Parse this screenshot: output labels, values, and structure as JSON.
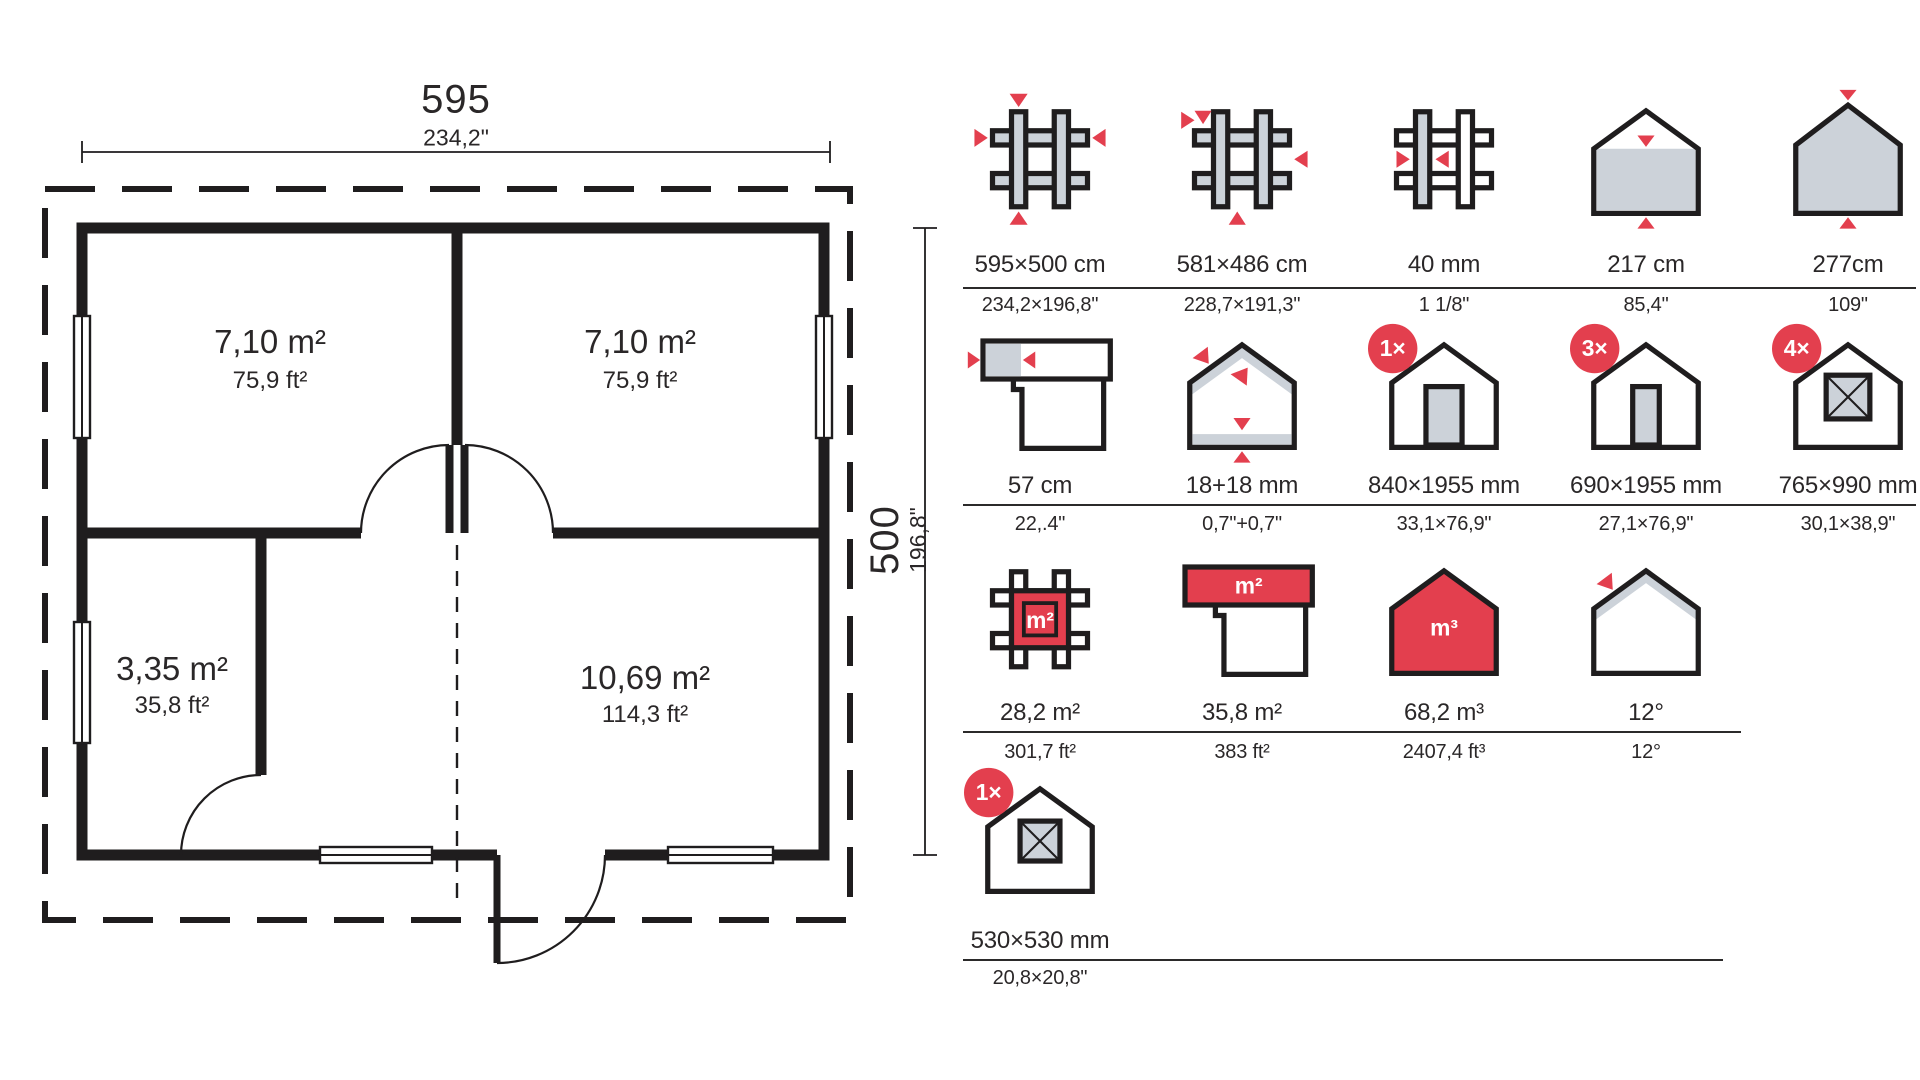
{
  "floor_plan": {
    "width_dim": {
      "value": "595",
      "inches": "234,2\""
    },
    "height_dim": {
      "value": "500",
      "inches": "196,8\""
    },
    "rooms": [
      {
        "area": "7,10 m²",
        "area_ft": "75,9 ft²"
      },
      {
        "area": "7,10 m²",
        "area_ft": "75,9 ft²"
      },
      {
        "area": "3,35 m²",
        "area_ft": "35,8 ft²"
      },
      {
        "area": "10,69 m²",
        "area_ft": "114,3 ft²"
      }
    ]
  },
  "legend": {
    "rows": [
      {
        "items": [
          {
            "icon": "log-frame-outer-dims-icon",
            "metric": "595×500 cm",
            "imperial": "234,2×196,8\""
          },
          {
            "icon": "log-frame-inner-dims-icon",
            "metric": "581×486 cm",
            "imperial": "228,7×191,3\""
          },
          {
            "icon": "wall-thickness-icon",
            "metric": "40 mm",
            "imperial": "1 1/8\""
          },
          {
            "icon": "wall-height-icon",
            "metric": "217 cm",
            "imperial": "85,4\""
          },
          {
            "icon": "ridge-height-icon",
            "metric": "277cm",
            "imperial": "109\""
          }
        ]
      },
      {
        "items": [
          {
            "icon": "roof-overhang-icon",
            "metric": "57 cm",
            "imperial": "22,.4\""
          },
          {
            "icon": "roof-floor-boards-icon",
            "metric": "18+18 mm",
            "imperial": "0,7\"+0,7\""
          },
          {
            "icon": "door-icon",
            "badge": "1×",
            "metric": "840×1955 mm",
            "imperial": "33,1×76,9\""
          },
          {
            "icon": "door-narrow-icon",
            "badge": "3×",
            "metric": "690×1955 mm",
            "imperial": "27,1×76,9\""
          },
          {
            "icon": "window-icon",
            "badge": "4×",
            "metric": "765×990 mm",
            "imperial": "30,1×38,9\""
          }
        ]
      },
      {
        "items": [
          {
            "icon": "footprint-area-icon",
            "icon_label": "m²",
            "metric": "28,2 m²",
            "imperial": "301,7 ft²"
          },
          {
            "icon": "roof-area-icon",
            "icon_label": "m²",
            "metric": "35,8 m²",
            "imperial": "383 ft²"
          },
          {
            "icon": "volume-icon",
            "icon_label": "m³",
            "metric": "68,2 m³",
            "imperial": "2407,4 ft³"
          },
          {
            "icon": "roof-angle-icon",
            "metric": "12°",
            "imperial": "12°"
          }
        ]
      },
      {
        "items": [
          {
            "icon": "small-window-icon",
            "badge": "1×",
            "metric": "530×530 mm",
            "imperial": "20,8×20,8\""
          }
        ]
      }
    ]
  },
  "colors": {
    "accent": "#e33f4e",
    "shape_fill": "#ccd2d9",
    "ink": "#1f1d1e"
  }
}
